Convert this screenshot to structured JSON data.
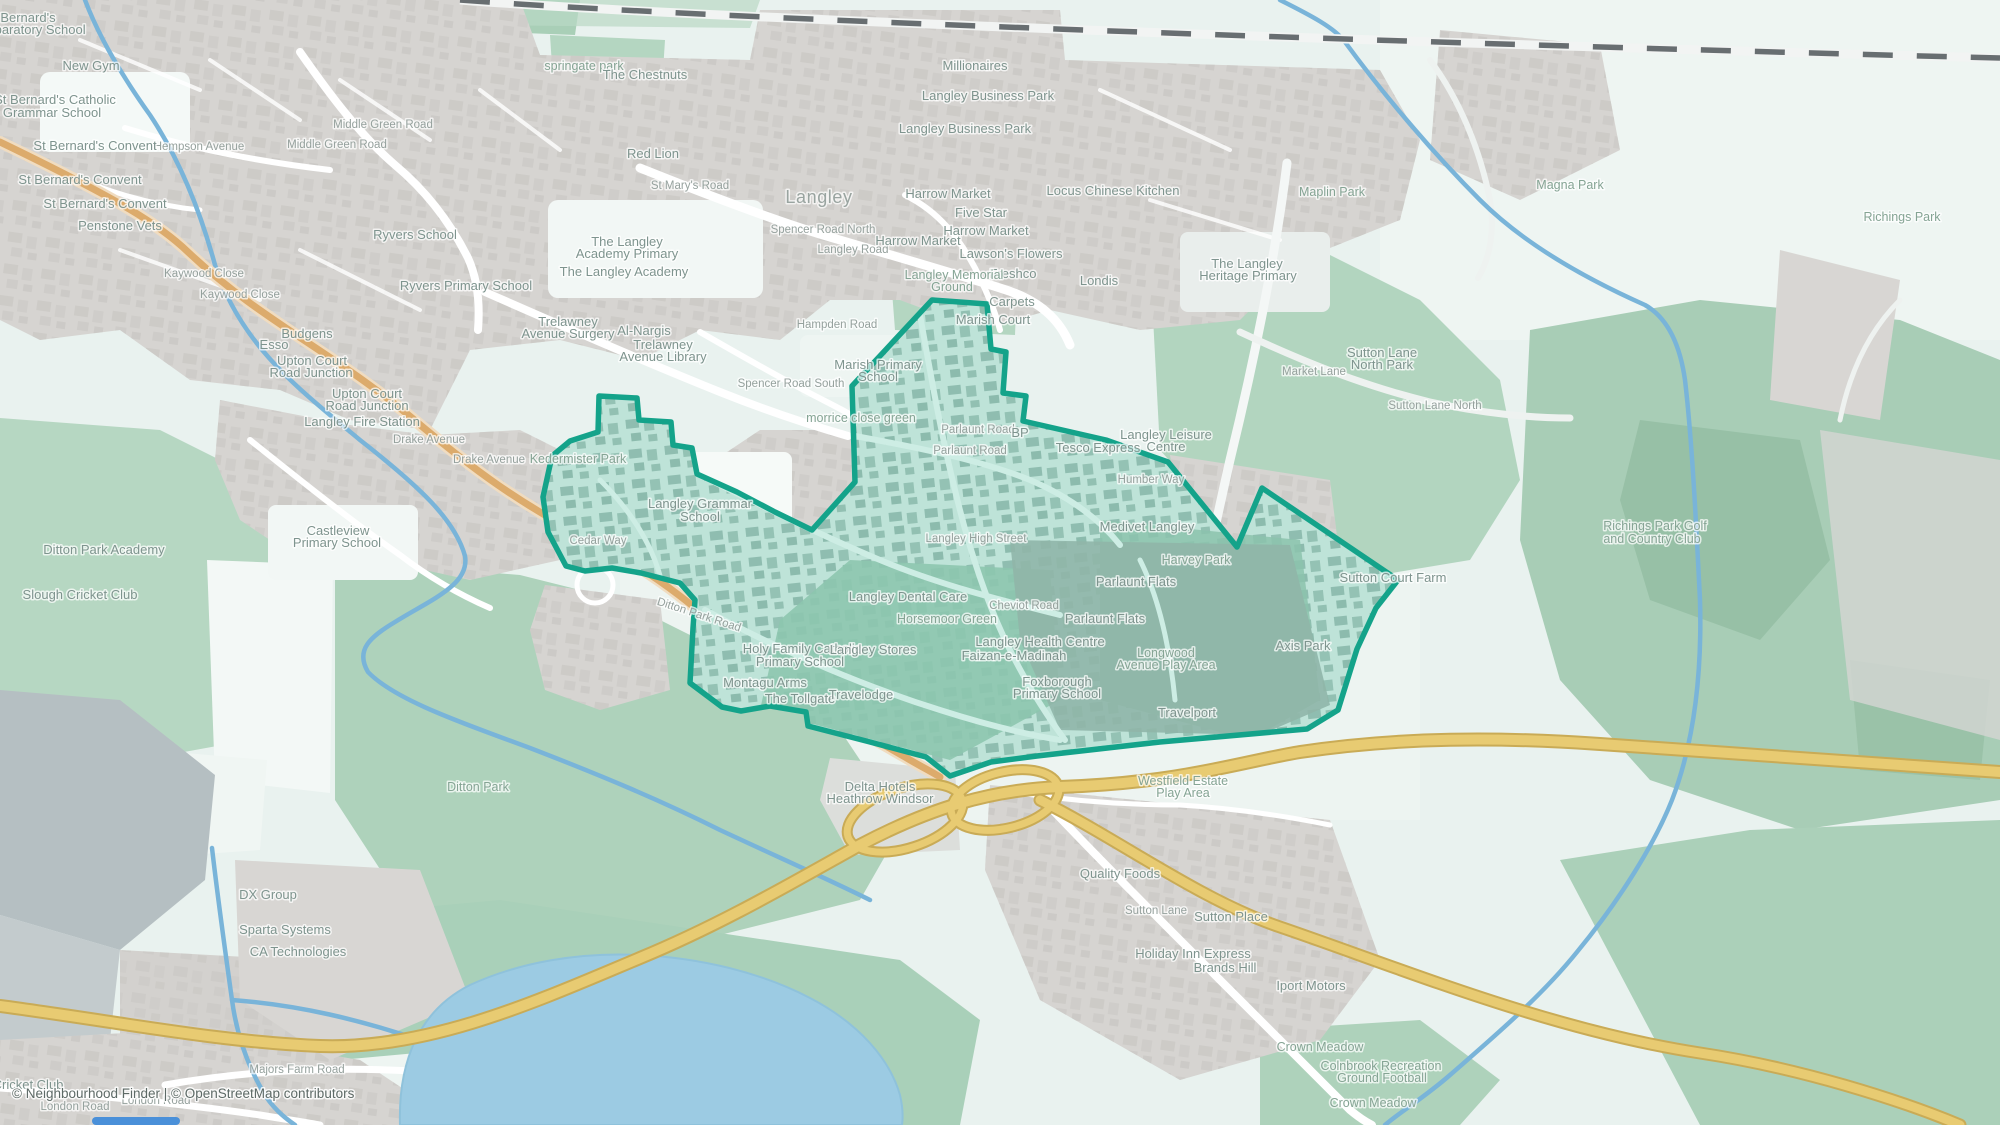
{
  "map": {
    "kind": "openstreetmap-style neighbourhood map with highlighted boundary",
    "colors": {
      "boundary_teal": "#14a38a",
      "boundary_fill": "rgba(20,163,138,0.13)",
      "motorway_yellow": "#e8cb72",
      "secondary_orange": "#ddab6c",
      "water_blue": "#7ab4d8",
      "lake_blue": "#9ccbe3",
      "park_green": "#b5d7c1",
      "woods_green": "#a3cab1",
      "urban_grey": "#d6d4d1",
      "background": "#e9f2ef"
    },
    "labels": [
      {
        "t": "St Bernard's",
        "x": 20,
        "y": 22
      },
      {
        "t": "Preparatory School",
        "x": 30,
        "y": 34
      },
      {
        "t": "New Gym",
        "x": 91,
        "y": 70
      },
      {
        "t": "St Bernard's Catholic",
        "x": 55,
        "y": 104
      },
      {
        "t": "Grammar School",
        "x": 52,
        "y": 117
      },
      {
        "t": "Hempson Avenue",
        "x": 199,
        "y": 150,
        "c": "road"
      },
      {
        "t": "Middle Green Road",
        "x": 383,
        "y": 128,
        "c": "road"
      },
      {
        "t": "Middle Green Road",
        "x": 337,
        "y": 148,
        "c": "road"
      },
      {
        "t": "St Bernard's Convent",
        "x": 95,
        "y": 150
      },
      {
        "t": "St Bernard's Convent",
        "x": 80,
        "y": 184
      },
      {
        "t": "St Bernard's Convent",
        "x": 105,
        "y": 208
      },
      {
        "t": "Penstone Vets",
        "x": 120,
        "y": 230
      },
      {
        "t": "springate park",
        "x": 584,
        "y": 70,
        "c": "park"
      },
      {
        "t": "The Chestnuts",
        "x": 645,
        "y": 79
      },
      {
        "t": "Red Lion",
        "x": 653,
        "y": 158
      },
      {
        "t": "St Mary's Road",
        "x": 690,
        "y": 189,
        "c": "road"
      },
      {
        "t": "Millionaires",
        "x": 975,
        "y": 70
      },
      {
        "t": "Langley Business Park",
        "x": 988,
        "y": 100
      },
      {
        "t": "Langley Business Park",
        "x": 965,
        "y": 133
      },
      {
        "t": "Langley",
        "x": 819,
        "y": 203,
        "c": "town"
      },
      {
        "t": "Locus Chinese Kitchen",
        "x": 1113,
        "y": 195
      },
      {
        "t": "Maplin Park",
        "x": 1332,
        "y": 196,
        "c": "park"
      },
      {
        "t": "Magna Park",
        "x": 1570,
        "y": 189,
        "c": "park"
      },
      {
        "t": "Richings Park",
        "x": 1902,
        "y": 221,
        "c": "park"
      },
      {
        "t": "Spencer Road North",
        "x": 823,
        "y": 233,
        "c": "road"
      },
      {
        "t": "Langley Road",
        "x": 853,
        "y": 253,
        "c": "road"
      },
      {
        "t": "Harrow Market",
        "x": 948,
        "y": 198
      },
      {
        "t": "Five Star",
        "x": 981,
        "y": 217
      },
      {
        "t": "Harrow Market",
        "x": 918,
        "y": 245
      },
      {
        "t": "Harrow Market",
        "x": 986,
        "y": 235
      },
      {
        "t": "Lawson's Flowers",
        "x": 1011,
        "y": 258
      },
      {
        "t": "Freshco",
        "x": 1013,
        "y": 278
      },
      {
        "t": "Langley Memorial",
        "x": 954,
        "y": 279,
        "c": "park"
      },
      {
        "t": "Ground",
        "x": 952,
        "y": 291,
        "c": "park"
      },
      {
        "t": "Londis",
        "x": 1099,
        "y": 285
      },
      {
        "t": "The Langley",
        "x": 1247,
        "y": 268
      },
      {
        "t": "Heritage Primary",
        "x": 1248,
        "y": 280
      },
      {
        "t": "Ryvers School",
        "x": 415,
        "y": 239
      },
      {
        "t": "Ryvers Primary School",
        "x": 466,
        "y": 290
      },
      {
        "t": "The Langley",
        "x": 627,
        "y": 246
      },
      {
        "t": "Academy Primary",
        "x": 627,
        "y": 258
      },
      {
        "t": "The Langley Academy",
        "x": 624,
        "y": 276
      },
      {
        "t": "Trelawney",
        "x": 568,
        "y": 326
      },
      {
        "t": "Avenue Surgery",
        "x": 568,
        "y": 338
      },
      {
        "t": "Al-Nargis",
        "x": 644,
        "y": 335
      },
      {
        "t": "Trelawney",
        "x": 663,
        "y": 349
      },
      {
        "t": "Avenue Library",
        "x": 663,
        "y": 361
      },
      {
        "t": "Hampden Road",
        "x": 837,
        "y": 328,
        "c": "road"
      },
      {
        "t": "Carpets",
        "x": 1012,
        "y": 306
      },
      {
        "t": "Marish Court",
        "x": 993,
        "y": 324
      },
      {
        "t": "Marish Primary",
        "x": 878,
        "y": 369
      },
      {
        "t": "School",
        "x": 878,
        "y": 381
      },
      {
        "t": "Spencer Road South",
        "x": 791,
        "y": 387,
        "c": "road"
      },
      {
        "t": "morrice close green",
        "x": 861,
        "y": 422,
        "c": "park"
      },
      {
        "t": "Kaywood Close",
        "x": 204,
        "y": 277,
        "c": "road"
      },
      {
        "t": "Kaywood Close",
        "x": 240,
        "y": 298,
        "c": "road"
      },
      {
        "t": "Budgens",
        "x": 307,
        "y": 338
      },
      {
        "t": "Esso",
        "x": 274,
        "y": 349
      },
      {
        "t": "Upton Court",
        "x": 312,
        "y": 365
      },
      {
        "t": "Road Junction",
        "x": 311,
        "y": 377
      },
      {
        "t": "Upton Court",
        "x": 367,
        "y": 398
      },
      {
        "t": "Road Junction",
        "x": 367,
        "y": 410
      },
      {
        "t": "Langley Fire Station",
        "x": 362,
        "y": 426
      },
      {
        "t": "Drake Avenue",
        "x": 429,
        "y": 443,
        "c": "road"
      },
      {
        "t": "Drake Avenue",
        "x": 489,
        "y": 463,
        "c": "road"
      },
      {
        "t": "Kedermister Park",
        "x": 578,
        "y": 463,
        "c": "park"
      },
      {
        "t": "Castleview",
        "x": 338,
        "y": 535
      },
      {
        "t": "Primary School",
        "x": 337,
        "y": 547
      },
      {
        "t": "Cedar Way",
        "x": 598,
        "y": 544,
        "c": "road"
      },
      {
        "t": "Langley Grammar",
        "x": 700,
        "y": 508
      },
      {
        "t": "School",
        "x": 700,
        "y": 521
      },
      {
        "t": "Ditton Park Road",
        "x": 698,
        "y": 618,
        "c": "road",
        "r": 18
      },
      {
        "t": "Parlaunt Road",
        "x": 978,
        "y": 433,
        "c": "road"
      },
      {
        "t": "Parlaunt Road",
        "x": 970,
        "y": 454,
        "c": "road"
      },
      {
        "t": "BP",
        "x": 1020,
        "y": 437
      },
      {
        "t": "Tesco Express",
        "x": 1098,
        "y": 452
      },
      {
        "t": "Langley Leisure",
        "x": 1166,
        "y": 439
      },
      {
        "t": "Centre",
        "x": 1166,
        "y": 451
      },
      {
        "t": "Humber Way",
        "x": 1151,
        "y": 483,
        "c": "road"
      },
      {
        "t": "Medivet Langley",
        "x": 1147,
        "y": 531
      },
      {
        "t": "Harvey Park",
        "x": 1196,
        "y": 564,
        "c": "park"
      },
      {
        "t": "Parlaunt Flats",
        "x": 1136,
        "y": 586
      },
      {
        "t": "Parlaunt Flats",
        "x": 1105,
        "y": 623
      },
      {
        "t": "Langley High Street",
        "x": 976,
        "y": 542,
        "c": "road"
      },
      {
        "t": "Langley Dental Care",
        "x": 908,
        "y": 601
      },
      {
        "t": "Cheviot Road",
        "x": 1024,
        "y": 609,
        "c": "road"
      },
      {
        "t": "Horsemoor Green",
        "x": 947,
        "y": 623,
        "c": "park"
      },
      {
        "t": "Langley Health Centre",
        "x": 1040,
        "y": 646
      },
      {
        "t": "Faizan-e-Madinah",
        "x": 1014,
        "y": 660
      },
      {
        "t": "Foxborough",
        "x": 1057,
        "y": 686
      },
      {
        "t": "Primary School",
        "x": 1057,
        "y": 698
      },
      {
        "t": "Longwood",
        "x": 1166,
        "y": 657,
        "c": "park"
      },
      {
        "t": "Avenue Play Area",
        "x": 1166,
        "y": 669,
        "c": "park"
      },
      {
        "t": "Axis Park",
        "x": 1303,
        "y": 650
      },
      {
        "t": "Travelport",
        "x": 1187,
        "y": 717
      },
      {
        "t": "Sutton Court Farm",
        "x": 1393,
        "y": 582
      },
      {
        "t": "Sutton Lane",
        "x": 1382,
        "y": 357
      },
      {
        "t": "North Park",
        "x": 1382,
        "y": 369
      },
      {
        "t": "Market Lane",
        "x": 1314,
        "y": 375,
        "c": "road"
      },
      {
        "t": "Sutton Lane North",
        "x": 1435,
        "y": 409,
        "c": "road"
      },
      {
        "t": "Richings Park Golf",
        "x": 1655,
        "y": 530,
        "c": "park"
      },
      {
        "t": "and Country Club",
        "x": 1652,
        "y": 543,
        "c": "park"
      },
      {
        "t": "Holy Family Catholic",
        "x": 802,
        "y": 653
      },
      {
        "t": "Primary School",
        "x": 800,
        "y": 666
      },
      {
        "t": "Langley Stores",
        "x": 873,
        "y": 654
      },
      {
        "t": "Montagu Arms",
        "x": 765,
        "y": 687
      },
      {
        "t": "The Tollgate",
        "x": 800,
        "y": 703
      },
      {
        "t": "Travelodge",
        "x": 861,
        "y": 699
      },
      {
        "t": "Delta Hotels",
        "x": 880,
        "y": 791
      },
      {
        "t": "Heathrow Windsor",
        "x": 880,
        "y": 803
      },
      {
        "t": "Ditton Park Academy",
        "x": 104,
        "y": 554
      },
      {
        "t": "Slough Cricket Club",
        "x": 80,
        "y": 599
      },
      {
        "t": "Ditton Park",
        "x": 478,
        "y": 791,
        "c": "park"
      },
      {
        "t": "DX Group",
        "x": 268,
        "y": 899
      },
      {
        "t": "Sparta Systems",
        "x": 285,
        "y": 934
      },
      {
        "t": "CA Technologies",
        "x": 298,
        "y": 956
      },
      {
        "t": "Westfield Estate",
        "x": 1183,
        "y": 785,
        "c": "park"
      },
      {
        "t": "Play Area",
        "x": 1183,
        "y": 797,
        "c": "park"
      },
      {
        "t": "Quality Foods",
        "x": 1120,
        "y": 878
      },
      {
        "t": "Sutton Lane",
        "x": 1156,
        "y": 914,
        "c": "road"
      },
      {
        "t": "Sutton Place",
        "x": 1231,
        "y": 921
      },
      {
        "t": "Holiday Inn Express",
        "x": 1193,
        "y": 958
      },
      {
        "t": "Brands Hill",
        "x": 1225,
        "y": 972
      },
      {
        "t": "Iport Motors",
        "x": 1311,
        "y": 990
      },
      {
        "t": "Crown Meadow",
        "x": 1320,
        "y": 1051,
        "c": "park"
      },
      {
        "t": "Colnbrook Recreation",
        "x": 1381,
        "y": 1070,
        "c": "park"
      },
      {
        "t": "Ground Football",
        "x": 1382,
        "y": 1082,
        "c": "park"
      },
      {
        "t": "Crown Meadow",
        "x": 1373,
        "y": 1107,
        "c": "park"
      },
      {
        "t": "Majors Farm Road",
        "x": 297,
        "y": 1073,
        "c": "road"
      },
      {
        "t": "Cricket Club",
        "x": 28,
        "y": 1089
      },
      {
        "t": "London Road",
        "x": 156,
        "y": 1104,
        "c": "road"
      },
      {
        "t": "London Road",
        "x": 75,
        "y": 1110,
        "c": "road"
      }
    ]
  },
  "attribution": {
    "text": "© Neighbourhood Finder | © OpenStreetMap contributors"
  }
}
